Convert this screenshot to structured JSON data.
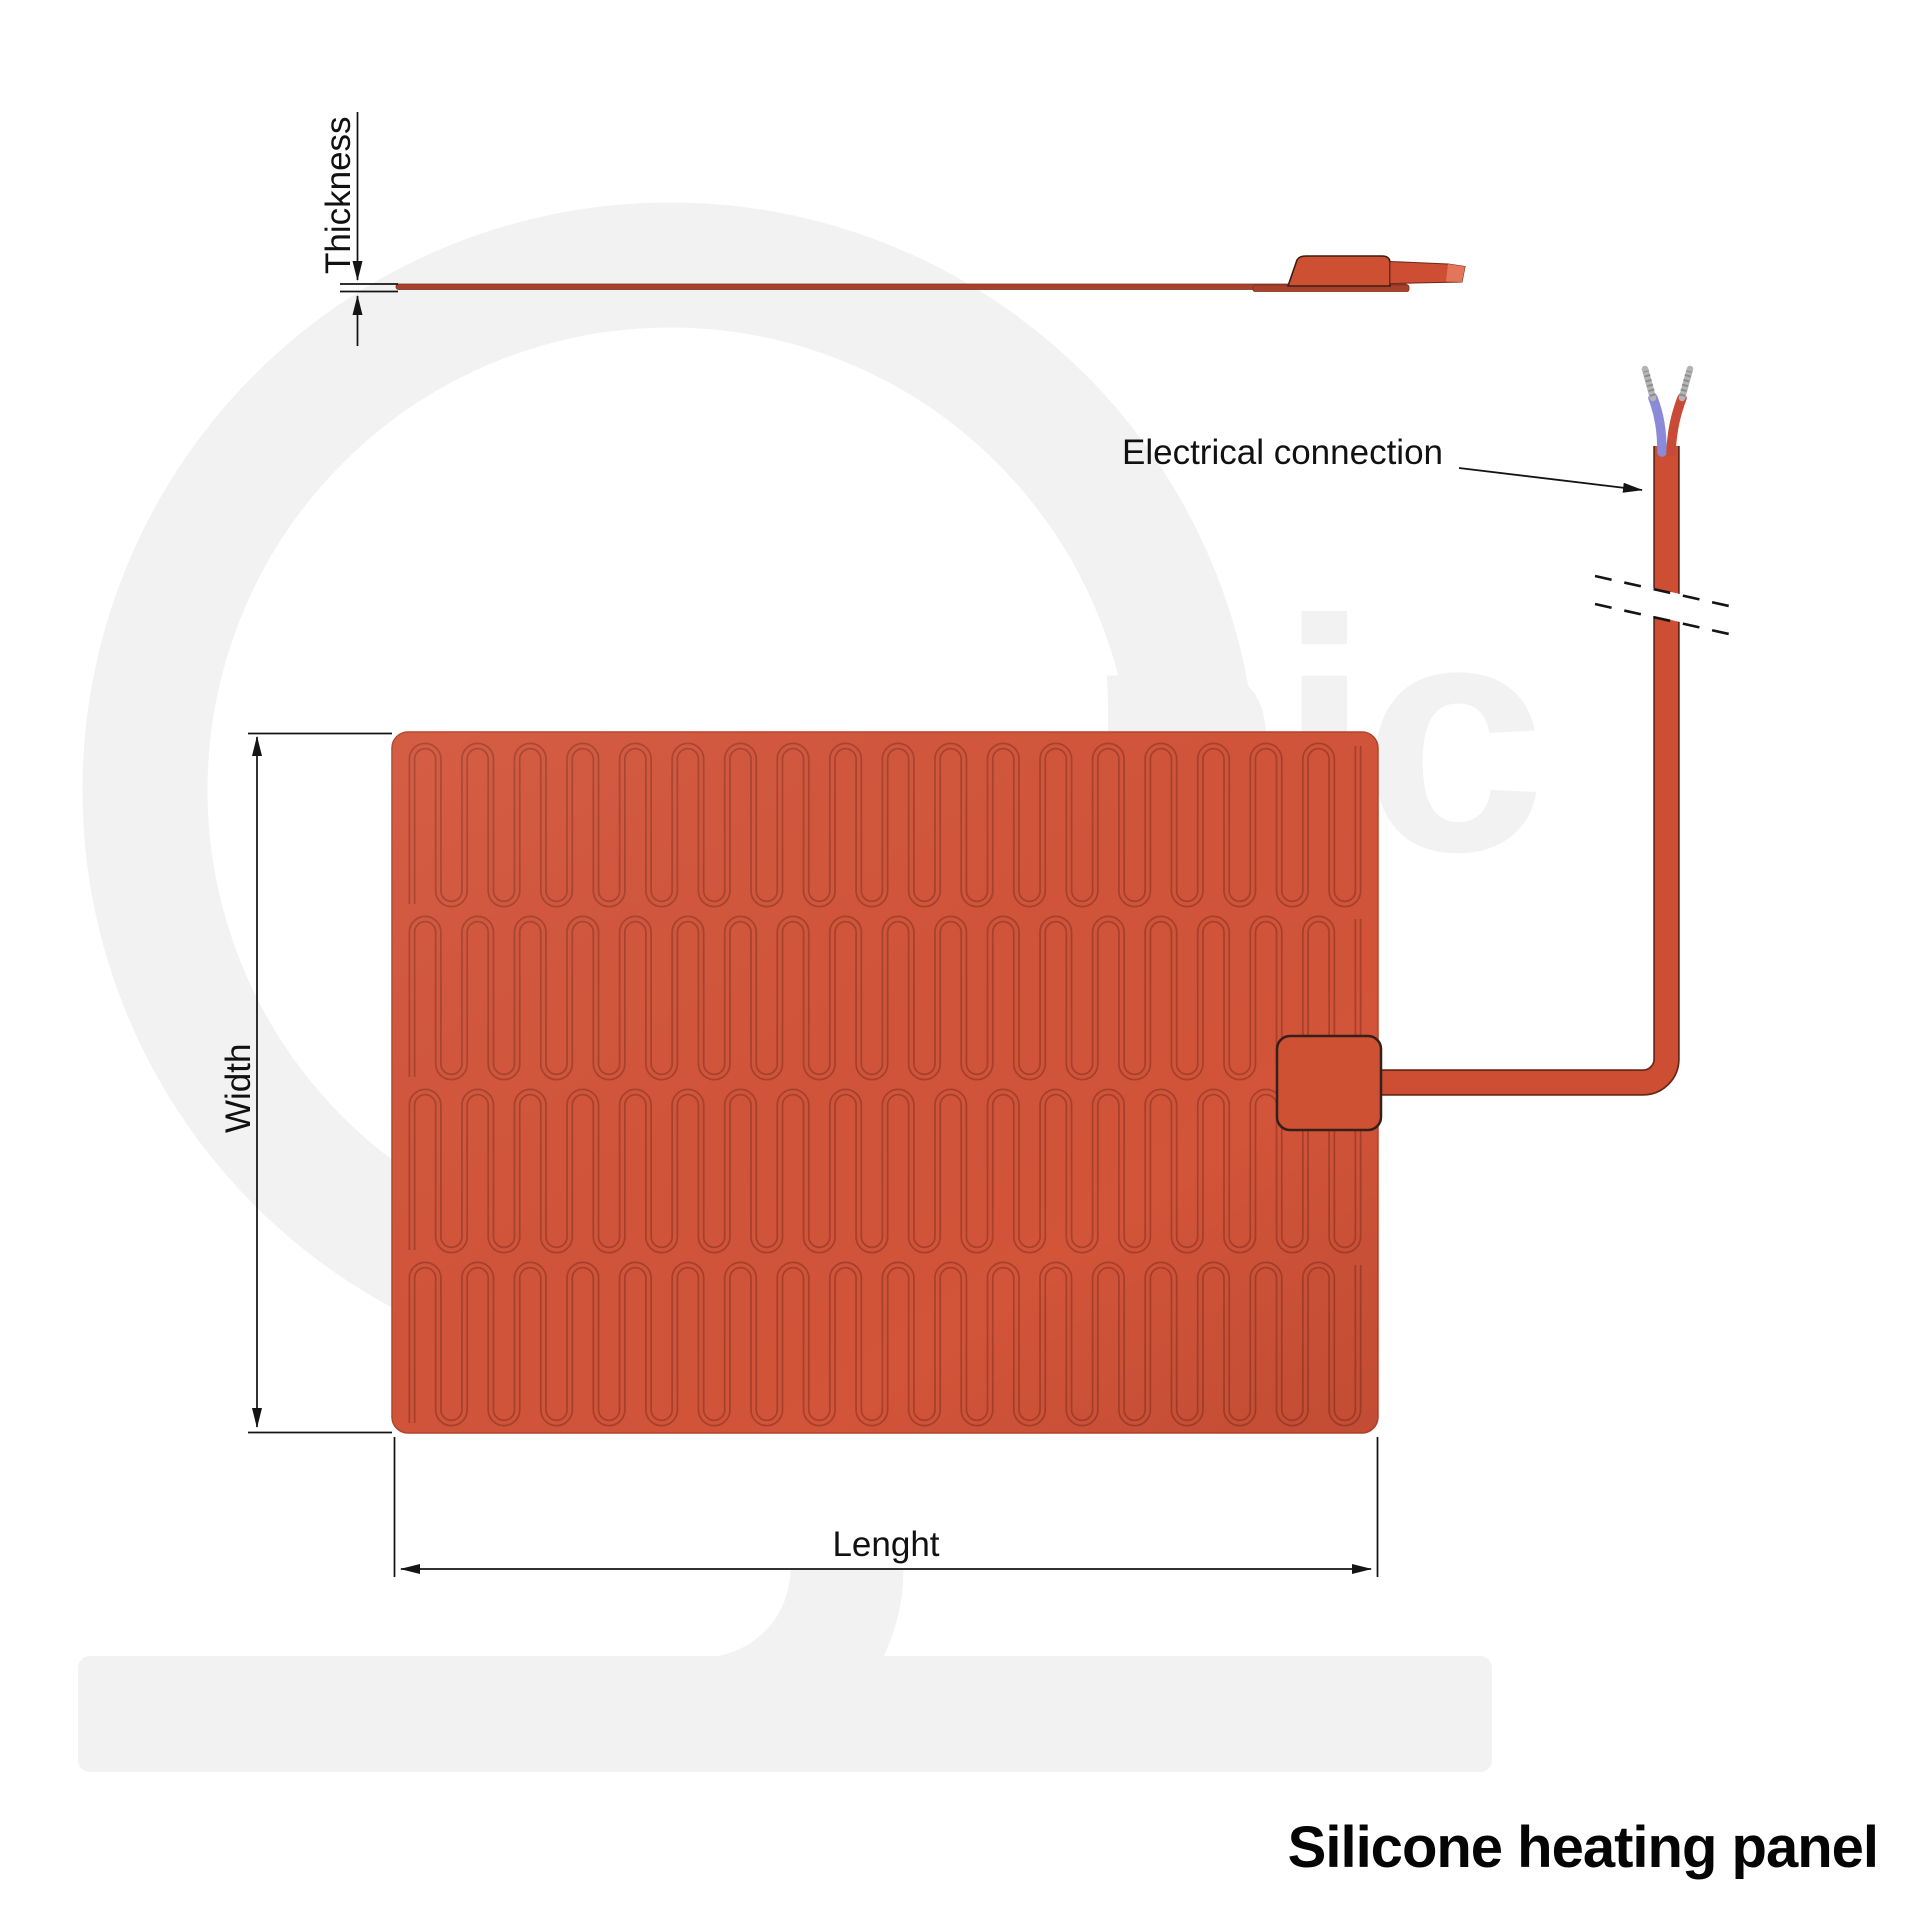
{
  "title": "Silicone heating panel",
  "labels": {
    "thickness": "Thickness",
    "width": "Width",
    "length": "Lenght",
    "electrical_connection": "Electrical connection"
  },
  "watermark": {
    "text": "nic"
  },
  "colors": {
    "panel_fill": "#d25439",
    "panel_outline": "#b2442c",
    "trace": "#a8402a",
    "cable_fill": "#cd4e33",
    "cable_outline": "#6b2818",
    "connector_fill": "#ce5134",
    "connector_outline": "#35201a",
    "side_line": "#a84129",
    "side_line_edge": "#7c2f1e",
    "side_bump": "#cd5033",
    "side_bump_edge": "#3b1d12",
    "side_tip_highlight": "#e2755a",
    "wire_blue": "#8a8ad8",
    "wire_red": "#c84a37",
    "wire_tip": "#b5b3b3",
    "wire_tip_shadow": "#8d8b8b",
    "dimension_line": "#141414",
    "text": "#111111",
    "watermark": "#f2f2f2",
    "background": "#ffffff"
  },
  "pattern": {
    "bands": 4,
    "legs_per_band": 37
  }
}
